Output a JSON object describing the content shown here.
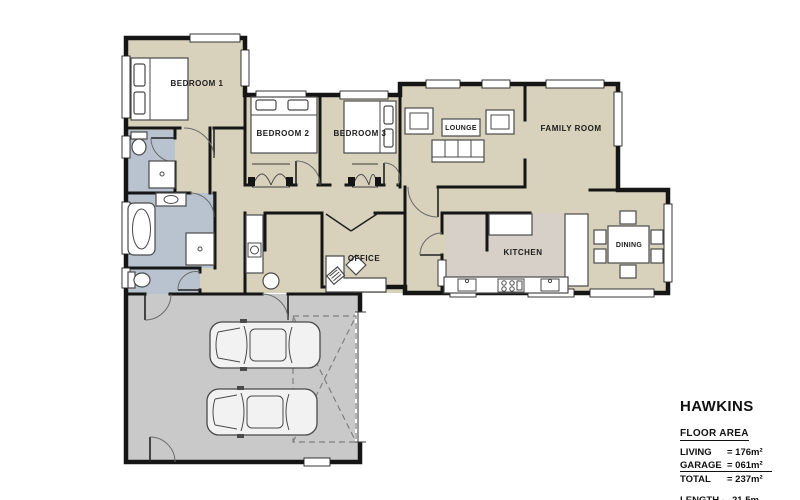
{
  "plan": {
    "rooms": [
      {
        "label": "BEDROOM 1"
      },
      {
        "label": "BEDROOM 2"
      },
      {
        "label": "BEDROOM 3"
      },
      {
        "label": "LOUNGE"
      },
      {
        "label": "FAMILY ROOM"
      },
      {
        "label": "OFFICE"
      },
      {
        "label": "KITCHEN"
      },
      {
        "label": "DINING"
      }
    ],
    "colors": {
      "floor": "#d8d2bc",
      "wet_area": "#b9c3cf",
      "kitchen_floor": "#d7d0c8",
      "garage": "#c9c9c9",
      "wall": "#151515"
    }
  },
  "legend": {
    "title": "HAWKINS",
    "section": "FLOOR AREA",
    "rows": [
      {
        "label": "LIVING",
        "value": "= 176m²"
      },
      {
        "label": "GARAGE",
        "value": "= 061m²"
      },
      {
        "label": "TOTAL",
        "value": "= 237m²"
      }
    ],
    "dims": [
      {
        "label": "LENGTH -",
        "value": "21.5m"
      },
      {
        "label": "WIDTH -",
        "value": "17.0m"
      }
    ]
  }
}
